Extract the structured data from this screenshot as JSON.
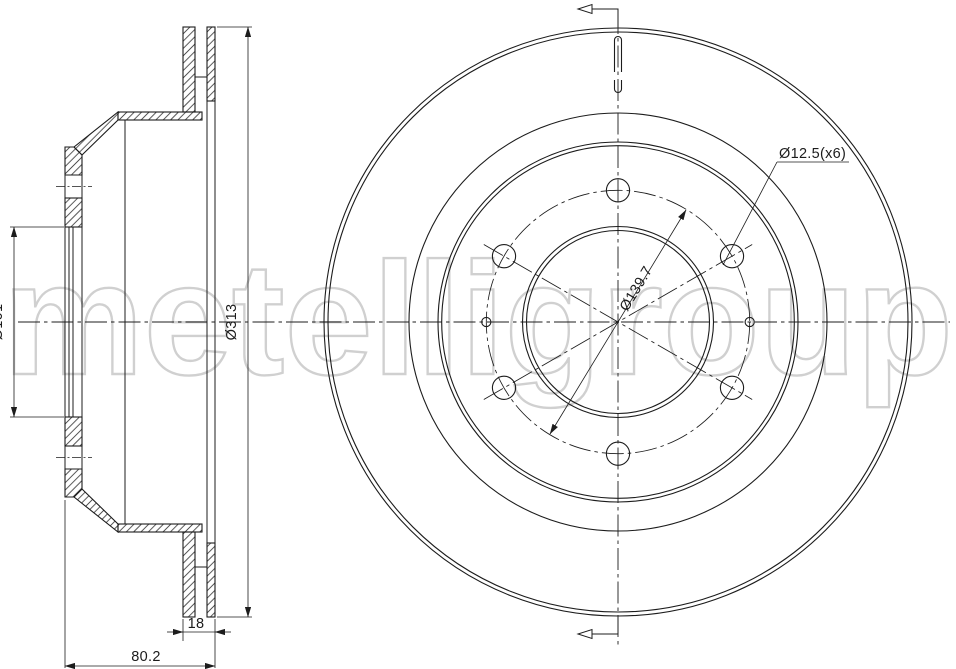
{
  "drawing": {
    "watermark": "metelligroup",
    "section_view": {
      "bore_diameter": "Ø101",
      "outer_diameter": "Ø313",
      "disc_thickness": "18",
      "overall_height": "80.2"
    },
    "front_view": {
      "bolt_holes": "Ø12.5(x6)",
      "pitch_circle": "Ø139.7"
    },
    "colors": {
      "line": "#1c1c1c",
      "watermark": "#d0d0d0",
      "background": "#ffffff"
    }
  }
}
